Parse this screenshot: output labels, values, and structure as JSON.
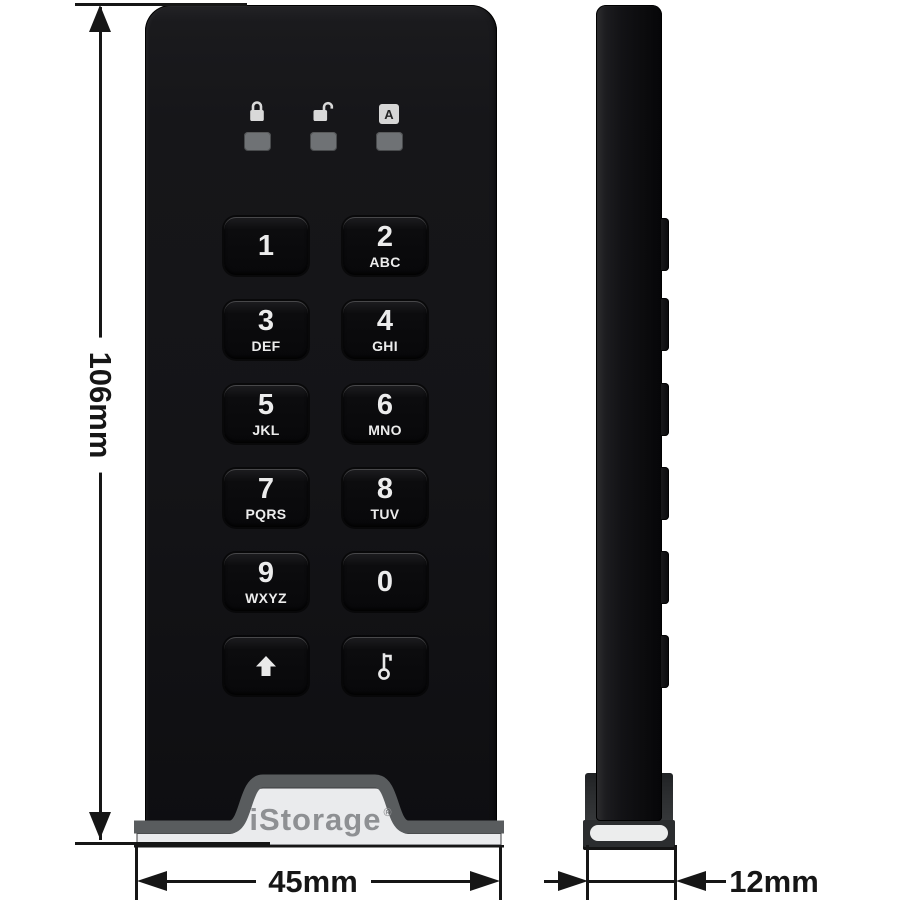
{
  "page": {
    "background": "#ffffff",
    "description": "iStorage encrypted USB drive technical dimension diagram, front and side views"
  },
  "dimensions": {
    "height": {
      "label": "106mm"
    },
    "width": {
      "label": "45mm"
    },
    "depth": {
      "label": "12mm"
    }
  },
  "front_view": {
    "indicators": [
      {
        "id": "locked",
        "icon": "lock-icon"
      },
      {
        "id": "unlocked",
        "icon": "unlock-icon"
      },
      {
        "id": "auto",
        "icon": "letter-a-icon",
        "label": "A"
      }
    ],
    "keypad": [
      {
        "digit": "1",
        "letters": ""
      },
      {
        "digit": "2",
        "letters": "ABC"
      },
      {
        "digit": "3",
        "letters": "DEF"
      },
      {
        "digit": "4",
        "letters": "GHI"
      },
      {
        "digit": "5",
        "letters": "JKL"
      },
      {
        "digit": "6",
        "letters": "MNO"
      },
      {
        "digit": "7",
        "letters": "PQRS"
      },
      {
        "digit": "8",
        "letters": "TUV"
      },
      {
        "digit": "9",
        "letters": "WXYZ"
      },
      {
        "digit": "0",
        "letters": ""
      },
      {
        "icon": "shift-arrow-icon"
      },
      {
        "icon": "key-icon"
      }
    ],
    "logo": {
      "text": "iStorage",
      "registered": "®"
    }
  },
  "side_view": {
    "button_count": 6
  },
  "colors": {
    "device_black": "#121214",
    "key_black": "#0a0a0c",
    "led_gray": "#6f7275",
    "icon_light": "#d9d9d9",
    "band_gray": "#595c5e",
    "silver": "#eaebed",
    "logo_gray": "#8e9093",
    "annotation": "#161616"
  }
}
